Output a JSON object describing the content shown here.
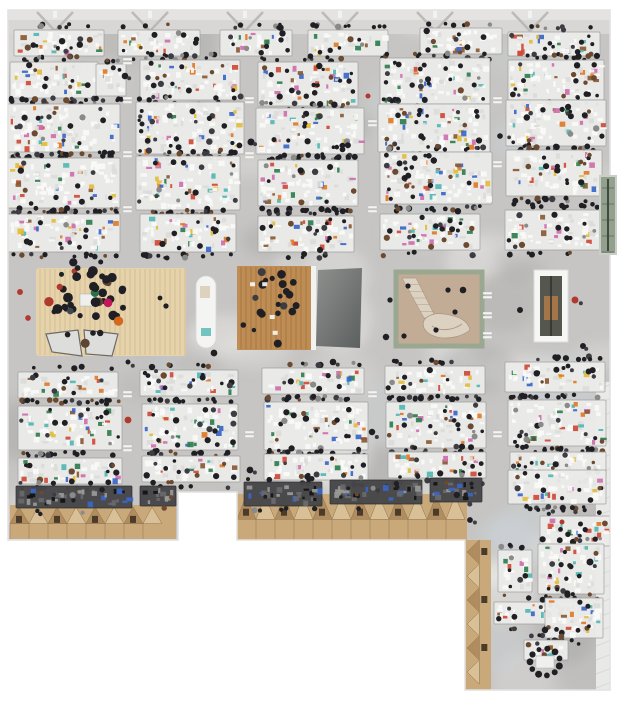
{
  "meta": {
    "title": "Aerial top-down photograph of a large open-plan studio office floor",
    "width": 620,
    "height": 701
  },
  "palette": {
    "background": "#ffffff",
    "floor_base": "#c6c5c3",
    "floor_light": "#e7e6e4",
    "floor_dark": "#a9a9a7",
    "floor_blue": "#ccd3d9",
    "floor_white": "#f0efed",
    "edge": "#e2e1df",
    "top_band": "#d8d7d5",
    "top_band_hi": "#e4e3e1",
    "truss": "#b4b4b2",
    "pillar": "#f2f2f0",
    "desk_light": "#ebebe9",
    "desk_stroke": "#9e9e9c",
    "desk_dark": "#47474a",
    "desk_dark_stroke": "#2b2b2d",
    "paper": "#fafaf8",
    "paper_dim": "#dcdcda",
    "person_dark": "#1f1f24",
    "person_alt": "#3c3c42",
    "person_brown": "#6b4a30",
    "person_gray": "#8a8a88",
    "wood_light": "#e6d3ab",
    "wood_light_line": "rgba(140,110,60,0.28)",
    "wood_warm": "#bf8c54",
    "wood_warm_line": "rgba(90,58,24,0.35)",
    "roof_base": "#c9a97a",
    "roof_light": "#d9c096",
    "roof_dark": "#b08c5e",
    "roof_seam": "#8c7450",
    "roof_window": "#4a3b2a",
    "atrium_frame": "#9aa791",
    "atrium_floor": "#c3ac96",
    "stair_light": "#ddd2c2",
    "stair_edge": "#a89a88",
    "dark_room_a": "#8e908e",
    "dark_room_b": "#5b5f5e",
    "shaft_frame": "#f6f6f4",
    "shaft_dark": "#55574f",
    "shaft_wood": "#a3764a",
    "glass_green": "#92a08d",
    "glass_frame": "#c9cec6",
    "glass_line": "#3f4a3e",
    "tarp": "#ebecea",
    "tarp_line": "#d8d8d6",
    "counter_white": "#f4f4f2",
    "triangle_fill": "#dddddb",
    "triangle_edge": "#6a6a68",
    "accents": [
      "#cf4a38",
      "#2f7d4f",
      "#3a66c9",
      "#e3bd3b",
      "#cf6fae",
      "#8a5a33",
      "#52b8b4",
      "#e07b28"
    ]
  },
  "scene": {
    "footprint": [
      [
        8,
        10
      ],
      [
        610,
        10
      ],
      [
        610,
        690
      ],
      [
        465,
        690
      ],
      [
        465,
        540
      ],
      [
        237,
        540
      ],
      [
        237,
        492
      ],
      [
        178,
        492
      ],
      [
        178,
        540
      ],
      [
        8,
        540
      ]
    ],
    "top_band": {
      "x": 8,
      "y": 10,
      "w": 602,
      "h": 24,
      "truss_xs": [
        55,
        150,
        245,
        340,
        435,
        530
      ]
    },
    "mottle_count": 90,
    "desk_clusters": [
      {
        "x": 14,
        "y": 30,
        "w": 90,
        "h": 26,
        "tone": "light"
      },
      {
        "x": 118,
        "y": 30,
        "w": 82,
        "h": 26,
        "tone": "light"
      },
      {
        "x": 220,
        "y": 30,
        "w": 72,
        "h": 26,
        "tone": "light"
      },
      {
        "x": 308,
        "y": 30,
        "w": 80,
        "h": 26,
        "tone": "light"
      },
      {
        "x": 420,
        "y": 28,
        "w": 82,
        "h": 26,
        "tone": "light"
      },
      {
        "x": 508,
        "y": 32,
        "w": 92,
        "h": 24,
        "tone": "light"
      },
      {
        "x": 10,
        "y": 62,
        "w": 88,
        "h": 36,
        "tone": "light"
      },
      {
        "x": 96,
        "y": 64,
        "w": 30,
        "h": 32,
        "tone": "light"
      },
      {
        "x": 140,
        "y": 60,
        "w": 100,
        "h": 40,
        "tone": "light"
      },
      {
        "x": 258,
        "y": 62,
        "w": 100,
        "h": 44,
        "tone": "light"
      },
      {
        "x": 380,
        "y": 58,
        "w": 110,
        "h": 46,
        "tone": "light"
      },
      {
        "x": 508,
        "y": 60,
        "w": 96,
        "h": 40,
        "tone": "light"
      },
      {
        "x": 8,
        "y": 104,
        "w": 112,
        "h": 48,
        "tone": "light"
      },
      {
        "x": 136,
        "y": 102,
        "w": 108,
        "h": 52,
        "tone": "light"
      },
      {
        "x": 256,
        "y": 108,
        "w": 108,
        "h": 46,
        "tone": "light"
      },
      {
        "x": 378,
        "y": 104,
        "w": 112,
        "h": 48,
        "tone": "light"
      },
      {
        "x": 506,
        "y": 100,
        "w": 100,
        "h": 46,
        "tone": "light"
      },
      {
        "x": 8,
        "y": 158,
        "w": 112,
        "h": 50,
        "tone": "light"
      },
      {
        "x": 136,
        "y": 156,
        "w": 104,
        "h": 54,
        "tone": "light"
      },
      {
        "x": 258,
        "y": 160,
        "w": 100,
        "h": 46,
        "tone": "light"
      },
      {
        "x": 380,
        "y": 152,
        "w": 112,
        "h": 52,
        "tone": "light"
      },
      {
        "x": 506,
        "y": 150,
        "w": 96,
        "h": 46,
        "tone": "light"
      },
      {
        "x": 8,
        "y": 214,
        "w": 112,
        "h": 38,
        "tone": "light"
      },
      {
        "x": 140,
        "y": 214,
        "w": 96,
        "h": 38,
        "tone": "light"
      },
      {
        "x": 258,
        "y": 216,
        "w": 96,
        "h": 36,
        "tone": "light"
      },
      {
        "x": 380,
        "y": 214,
        "w": 100,
        "h": 36,
        "tone": "light"
      },
      {
        "x": 505,
        "y": 210,
        "w": 96,
        "h": 40,
        "tone": "light"
      },
      {
        "x": 18,
        "y": 372,
        "w": 100,
        "h": 26,
        "tone": "light"
      },
      {
        "x": 140,
        "y": 370,
        "w": 98,
        "h": 26,
        "tone": "light"
      },
      {
        "x": 262,
        "y": 368,
        "w": 102,
        "h": 26,
        "tone": "light"
      },
      {
        "x": 385,
        "y": 366,
        "w": 100,
        "h": 28,
        "tone": "light"
      },
      {
        "x": 505,
        "y": 362,
        "w": 100,
        "h": 30,
        "tone": "light"
      },
      {
        "x": 18,
        "y": 406,
        "w": 104,
        "h": 44,
        "tone": "light"
      },
      {
        "x": 142,
        "y": 404,
        "w": 96,
        "h": 46,
        "tone": "light"
      },
      {
        "x": 264,
        "y": 402,
        "w": 104,
        "h": 48,
        "tone": "light"
      },
      {
        "x": 386,
        "y": 402,
        "w": 100,
        "h": 46,
        "tone": "light"
      },
      {
        "x": 508,
        "y": 400,
        "w": 98,
        "h": 46,
        "tone": "light"
      },
      {
        "x": 18,
        "y": 458,
        "w": 104,
        "h": 26,
        "tone": "light"
      },
      {
        "x": 142,
        "y": 456,
        "w": 98,
        "h": 26,
        "tone": "light"
      },
      {
        "x": 264,
        "y": 454,
        "w": 104,
        "h": 26,
        "tone": "light"
      },
      {
        "x": 388,
        "y": 452,
        "w": 98,
        "h": 26,
        "tone": "light"
      },
      {
        "x": 510,
        "y": 452,
        "w": 96,
        "h": 26,
        "tone": "light"
      },
      {
        "x": 16,
        "y": 486,
        "w": 116,
        "h": 22,
        "tone": "dark"
      },
      {
        "x": 140,
        "y": 486,
        "w": 36,
        "h": 20,
        "tone": "dark"
      },
      {
        "x": 244,
        "y": 482,
        "w": 78,
        "h": 24,
        "tone": "dark"
      },
      {
        "x": 330,
        "y": 480,
        "w": 92,
        "h": 24,
        "tone": "dark"
      },
      {
        "x": 430,
        "y": 478,
        "w": 52,
        "h": 24,
        "tone": "dark"
      },
      {
        "x": 508,
        "y": 470,
        "w": 98,
        "h": 34,
        "tone": "light"
      },
      {
        "x": 540,
        "y": 516,
        "w": 70,
        "h": 30,
        "tone": "light"
      },
      {
        "x": 498,
        "y": 550,
        "w": 34,
        "h": 42,
        "tone": "light"
      },
      {
        "x": 538,
        "y": 544,
        "w": 66,
        "h": 50,
        "tone": "light"
      },
      {
        "x": 494,
        "y": 602,
        "w": 84,
        "h": 22,
        "tone": "light"
      },
      {
        "x": 545,
        "y": 598,
        "w": 58,
        "h": 40,
        "tone": "light"
      },
      {
        "x": 524,
        "y": 640,
        "w": 44,
        "h": 20,
        "tone": "light"
      }
    ],
    "roof_segments": [
      {
        "x": 10,
        "y": 505,
        "w": 166,
        "h": 34,
        "orient": "h"
      },
      {
        "x": 237,
        "y": 494,
        "w": 230,
        "h": 46,
        "orient": "h"
      },
      {
        "x": 465,
        "y": 540,
        "w": 26,
        "h": 150,
        "orient": "v"
      }
    ],
    "tarp_strips": [
      {
        "x": 596,
        "y": 382,
        "w": 16,
        "h": 158
      },
      {
        "x": 596,
        "y": 540,
        "w": 16,
        "h": 150
      }
    ],
    "markers": [
      [
        127,
        58
      ],
      [
        127,
        97
      ],
      [
        127,
        151
      ],
      [
        127,
        206
      ],
      [
        249,
        97
      ],
      [
        249,
        152
      ],
      [
        372,
        120
      ],
      [
        372,
        206
      ],
      [
        497,
        97
      ],
      [
        497,
        161
      ],
      [
        127,
        391
      ],
      [
        127,
        445
      ],
      [
        249,
        431
      ],
      [
        372,
        391
      ],
      [
        497,
        431
      ],
      [
        487,
        292
      ],
      [
        487,
        312
      ],
      [
        487,
        332
      ]
    ],
    "features": {
      "wood_floor_left": {
        "x": 36,
        "y": 268,
        "w": 150,
        "h": 88
      },
      "crowd": {
        "cx": 88,
        "cy": 302,
        "rx": 40,
        "ry": 44,
        "n": 46,
        "table": {
          "x": 80,
          "y": 294,
          "w": 16,
          "h": 12
        }
      },
      "triangles": [
        [
          [
            46,
            334
          ],
          [
            78,
            330
          ],
          [
            82,
            356
          ],
          [
            52,
            352
          ]
        ],
        [
          [
            84,
            330
          ],
          [
            118,
            334
          ],
          [
            112,
            356
          ],
          [
            86,
            354
          ]
        ]
      ],
      "white_counter": {
        "x": 196,
        "y": 276,
        "w": 20,
        "h": 72
      },
      "wood_meeting": {
        "x": 237,
        "y": 266,
        "w": 74,
        "h": 84,
        "people_n": 22
      },
      "dark_room": {
        "poly": [
          [
            318,
            270
          ],
          [
            362,
            268
          ],
          [
            360,
            348
          ],
          [
            316,
            346
          ]
        ]
      },
      "atrium": {
        "x": 396,
        "y": 272,
        "w": 86,
        "h": 74,
        "stair": [
          [
            402,
            278
          ],
          [
            416,
            278
          ],
          [
            436,
            318
          ],
          [
            424,
            318
          ]
        ],
        "dots": [
          [
            408,
            286
          ],
          [
            448,
            290
          ],
          [
            455,
            312
          ],
          [
            436,
            330
          ],
          [
            404,
            336
          ]
        ]
      },
      "shaft": {
        "x": 534,
        "y": 270,
        "w": 34,
        "h": 72
      },
      "glass_protrusion": {
        "x": 600,
        "y": 176,
        "w": 16,
        "h": 78
      },
      "people_ring": {
        "cx": 545,
        "cy": 662,
        "r": 15,
        "n": 11
      }
    },
    "scatter_people": [
      [
        125,
        76
      ],
      [
        251,
        142
      ],
      [
        368,
        96
      ],
      [
        500,
        136
      ],
      [
        20,
        292
      ],
      [
        28,
        318
      ],
      [
        128,
        362
      ],
      [
        152,
        367
      ],
      [
        214,
        353
      ],
      [
        333,
        362
      ],
      [
        390,
        300
      ],
      [
        386,
        337
      ],
      [
        463,
        290
      ],
      [
        520,
        310
      ],
      [
        575,
        300
      ],
      [
        583,
        346
      ],
      [
        128,
        420
      ],
      [
        250,
        470
      ],
      [
        372,
        432
      ],
      [
        568,
        366
      ],
      [
        545,
        630
      ],
      [
        562,
        522
      ],
      [
        590,
        562
      ],
      [
        470,
        520
      ],
      [
        200,
        246
      ],
      [
        320,
        250
      ],
      [
        160,
        298
      ],
      [
        166,
        306
      ]
    ]
  }
}
